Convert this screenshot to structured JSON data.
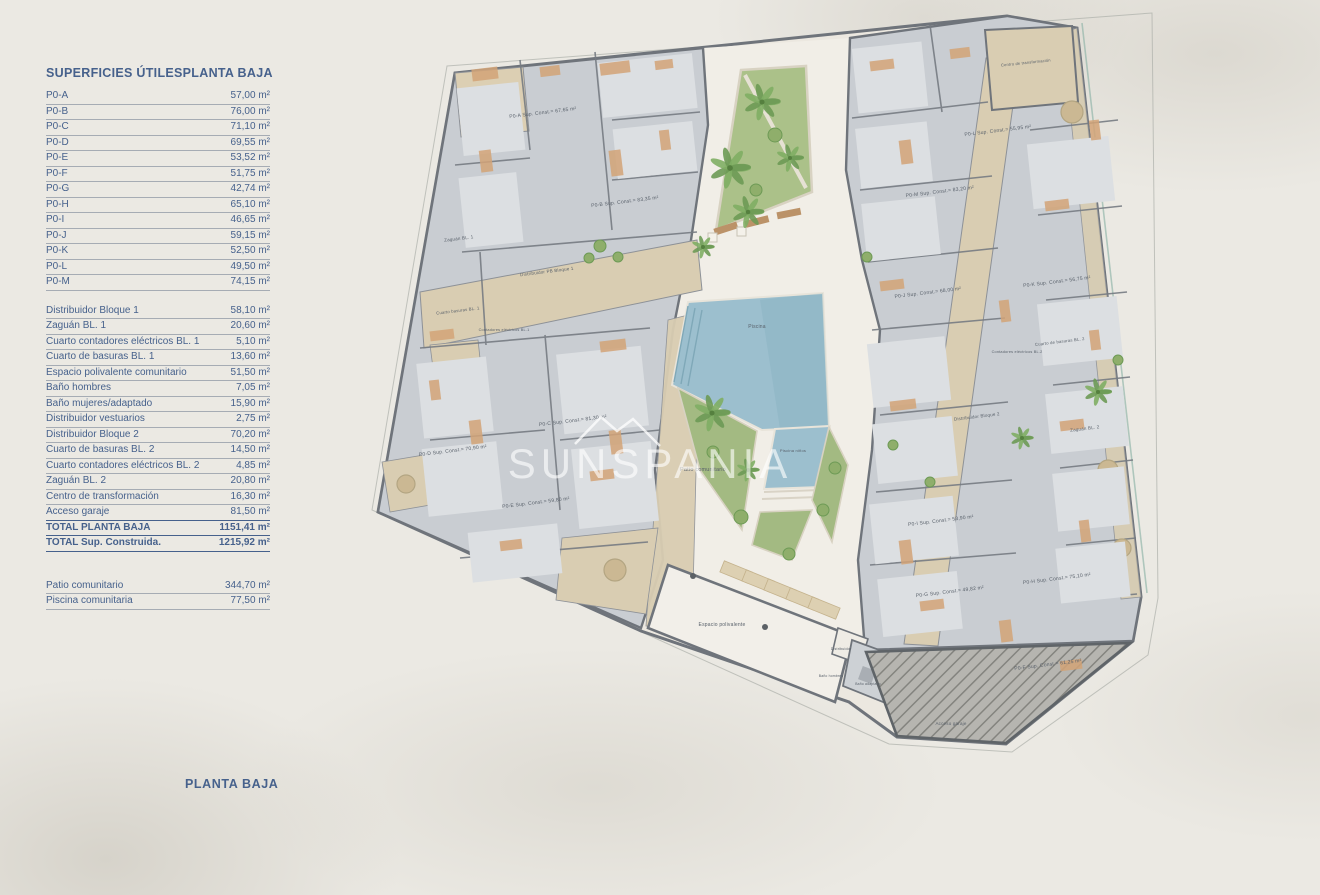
{
  "page": {
    "background": "#ebe9e3",
    "accent_blue": "#46618c"
  },
  "panel": {
    "header": {
      "col1": "SUPERFICIES ÚTILES",
      "col2": "PLANTA BAJA"
    },
    "sections": [
      {
        "rows": [
          {
            "label": "P0-A",
            "value": "57,00 m²"
          },
          {
            "label": "P0-B",
            "value": "76,00 m²"
          },
          {
            "label": "P0-C",
            "value": "71,10 m²"
          },
          {
            "label": "P0-D",
            "value": "69,55 m²"
          },
          {
            "label": "P0-E",
            "value": "53,52 m²"
          },
          {
            "label": "P0-F",
            "value": "51,75 m²"
          },
          {
            "label": "P0-G",
            "value": "42,74 m²"
          },
          {
            "label": "P0-H",
            "value": "65,10 m²"
          },
          {
            "label": "P0-I",
            "value": "46,65 m²"
          },
          {
            "label": "P0-J",
            "value": "59,15 m²"
          },
          {
            "label": "P0-K",
            "value": "52,50 m²"
          },
          {
            "label": "P0-L",
            "value": "49,50 m²"
          },
          {
            "label": "P0-M",
            "value": "74,15 m²"
          }
        ]
      },
      {
        "rows": [
          {
            "label": "Distribuidor Bloque 1",
            "value": "58,10 m²"
          },
          {
            "label": "Zaguán BL. 1",
            "value": "20,60 m²"
          },
          {
            "label": "Cuarto contadores eléctricos BL. 1",
            "value": "5,10 m²"
          },
          {
            "label": "Cuarto de basuras BL. 1",
            "value": "13,60 m²"
          },
          {
            "label": "Espacio polivalente comunitario",
            "value": "51,50 m²"
          },
          {
            "label": "Baño hombres",
            "value": "7,05 m²"
          },
          {
            "label": "Baño mujeres/adaptado",
            "value": "15,90 m²"
          },
          {
            "label": "Distribuidor vestuarios",
            "value": "2,75 m²"
          },
          {
            "label": "Distribuidor Bloque 2",
            "value": "70,20 m²"
          },
          {
            "label": "Cuarto de basuras BL. 2",
            "value": "14,50 m²"
          },
          {
            "label": "Cuarto contadores eléctricos BL. 2",
            "value": "4,85 m²"
          },
          {
            "label": "Zaguán BL. 2",
            "value": "20,80 m²"
          },
          {
            "label": "Centro de transformación",
            "value": "16,30 m²"
          },
          {
            "label": "Acceso garaje",
            "value": "81,50 m²",
            "accent": true
          },
          {
            "label": "TOTAL PLANTA BAJA",
            "value": "1151,41 m²",
            "bold": true,
            "accent": true
          },
          {
            "label": "TOTAL Sup. Construida.",
            "value": "1215,92 m²",
            "bold": true,
            "accent": true
          }
        ]
      },
      {
        "rows": [
          {
            "label": "Patio comunitario",
            "value": "344,70 m²"
          },
          {
            "label": "Piscina comunitaria",
            "value": "77,50 m²"
          }
        ]
      }
    ],
    "footer_label": "PLANTA BAJA"
  },
  "watermark": {
    "text": "SUNSPANIA"
  },
  "plan": {
    "labels": [
      {
        "t": "P0-A Sup. Const.= 67,65 m²",
        "x": 543,
        "y": 114,
        "s": 5,
        "r": -7
      },
      {
        "t": "P0-B Sup. Const.= 83,35 m²",
        "x": 625,
        "y": 203,
        "s": 5,
        "r": -7
      },
      {
        "t": "Zaguán BL. 1",
        "x": 459,
        "y": 240,
        "s": 4.5,
        "r": -7
      },
      {
        "t": "Distribuidor PB Bloque 1",
        "x": 547,
        "y": 273,
        "s": 4.5,
        "r": -7
      },
      {
        "t": "Cuarto basuras BL. 1",
        "x": 458,
        "y": 312,
        "s": 4.2,
        "r": -7
      },
      {
        "t": "Contadores eléctricos BL.1",
        "x": 504,
        "y": 331,
        "s": 3.8,
        "r": 0
      },
      {
        "t": "P0-D Sup. Const.= 70,90 m²",
        "x": 453,
        "y": 452,
        "s": 5,
        "r": -7
      },
      {
        "t": "P0-C Sup. Const.= 81,30 m²",
        "x": 573,
        "y": 422,
        "s": 5,
        "r": -7
      },
      {
        "t": "P0-E Sup. Const.= 59,80 m²",
        "x": 536,
        "y": 504,
        "s": 5,
        "r": -7
      },
      {
        "t": "Patio comunitario",
        "x": 703,
        "y": 471,
        "s": 5.5,
        "r": 0
      },
      {
        "t": "Piscina",
        "x": 757,
        "y": 328,
        "s": 5,
        "r": 0
      },
      {
        "t": "Piscina niños",
        "x": 793,
        "y": 452,
        "s": 4,
        "r": 0
      },
      {
        "t": "Centro de transformación",
        "x": 1026,
        "y": 64,
        "s": 4,
        "r": -6
      },
      {
        "t": "P0-L Sup. Const.= 55,95 m²",
        "x": 998,
        "y": 132,
        "s": 5,
        "r": -7
      },
      {
        "t": "P0-M Sup. Const.= 83,20 m²",
        "x": 940,
        "y": 193,
        "s": 5,
        "r": -7
      },
      {
        "t": "P0-K Sup. Const.= 56,75 m²",
        "x": 1057,
        "y": 283,
        "s": 5,
        "r": -7
      },
      {
        "t": "P0-J Sup. Const.= 68,00 m²",
        "x": 928,
        "y": 294,
        "s": 5,
        "r": -7
      },
      {
        "t": "Cuarto de basuras BL. 2",
        "x": 1060,
        "y": 343,
        "s": 4.2,
        "r": -7
      },
      {
        "t": "Contadores eléctricos BL.2",
        "x": 1017,
        "y": 353,
        "s": 3.8,
        "r": 0
      },
      {
        "t": "Distribuidor Bloque 2",
        "x": 977,
        "y": 418,
        "s": 4.5,
        "r": -7
      },
      {
        "t": "Zaguán BL. 2",
        "x": 1085,
        "y": 430,
        "s": 4.5,
        "r": -7
      },
      {
        "t": "P0-I Sup. Const.= 53,90 m²",
        "x": 941,
        "y": 522,
        "s": 5,
        "r": -7
      },
      {
        "t": "P0-G Sup. Const.= 49,82 m²",
        "x": 950,
        "y": 593,
        "s": 5,
        "r": -7
      },
      {
        "t": "P0-H Sup. Const.= 75,10 m²",
        "x": 1057,
        "y": 580,
        "s": 5,
        "r": -7
      },
      {
        "t": "P0-F Sup. Const.= 61,25 m²",
        "x": 1048,
        "y": 666,
        "s": 5,
        "r": -7
      },
      {
        "t": "Espacio polivalente",
        "x": 722,
        "y": 626,
        "s": 5,
        "r": 0
      },
      {
        "t": "Distribuidor",
        "x": 841,
        "y": 650,
        "s": 3.6,
        "r": 0
      },
      {
        "t": "Baño hombres",
        "x": 831,
        "y": 677,
        "s": 3.4,
        "r": 0
      },
      {
        "t": "Baño adaptado",
        "x": 868,
        "y": 685,
        "s": 3.4,
        "r": 0
      },
      {
        "t": "Acceso garaje",
        "x": 951,
        "y": 725,
        "s": 4.5,
        "r": 0
      }
    ]
  }
}
